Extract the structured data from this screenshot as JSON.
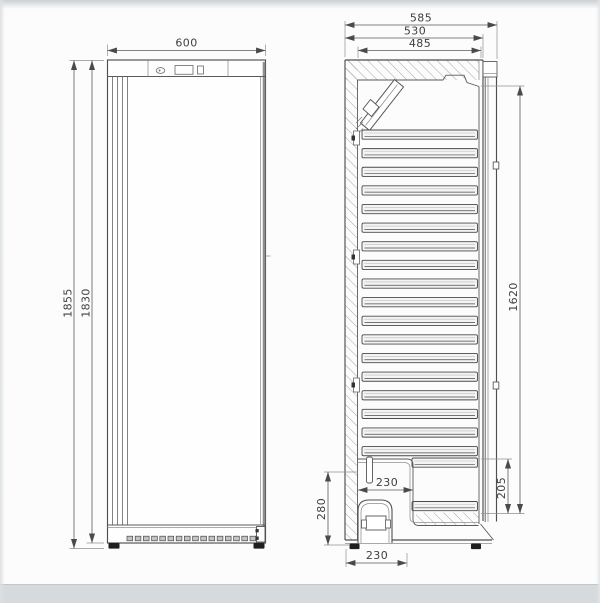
{
  "front_view": {
    "dimensions": {
      "width": "600",
      "overall_height": "1855",
      "body_height": "1830"
    },
    "vent_slot_count": 16,
    "hinge_line_count": 4
  },
  "side_view": {
    "dimensions": {
      "overall_depth": "585",
      "body_depth": "530",
      "interior_depth": "485",
      "interior_height": "1620",
      "recess_depth": "230",
      "recess_height": "280",
      "floor_height": "205",
      "base_depth": "230"
    },
    "shelf_slat_count": 18,
    "short_slat_count": 2
  },
  "style": {
    "line_color": "#4f4f4f",
    "dim_text_color": "#3f3f3f",
    "background": "#fcfcfc",
    "photo_edge_color": "#d6dadd"
  }
}
